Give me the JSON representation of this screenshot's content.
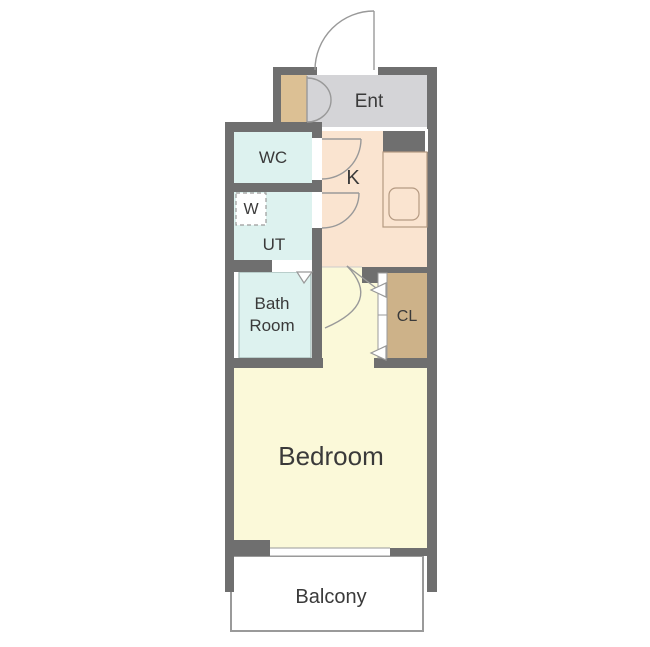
{
  "floorplan": {
    "labels": {
      "entrance": "Ent",
      "toilet": "WC",
      "washer": "W",
      "utility": "UT",
      "kitchen": "K",
      "bath_line1": "Bath",
      "bath_line2": "Room",
      "closet": "CL",
      "bedroom": "Bedroom",
      "balcony": "Balcony"
    },
    "colors": {
      "wall": "#6f6f6f",
      "entrance_floor": "#d4d4d7",
      "shoe_cabinet": "#dcc094",
      "closet": "#cdb289",
      "wet_area": "#ddf2ef",
      "kitchen_floor": "#fae4d0",
      "room_floor": "#fbf9d9",
      "balcony_floor": "#ffffff",
      "door_line": "#999999",
      "balcony_border": "#9a9a9a",
      "label_text": "#3a3a3a"
    }
  }
}
